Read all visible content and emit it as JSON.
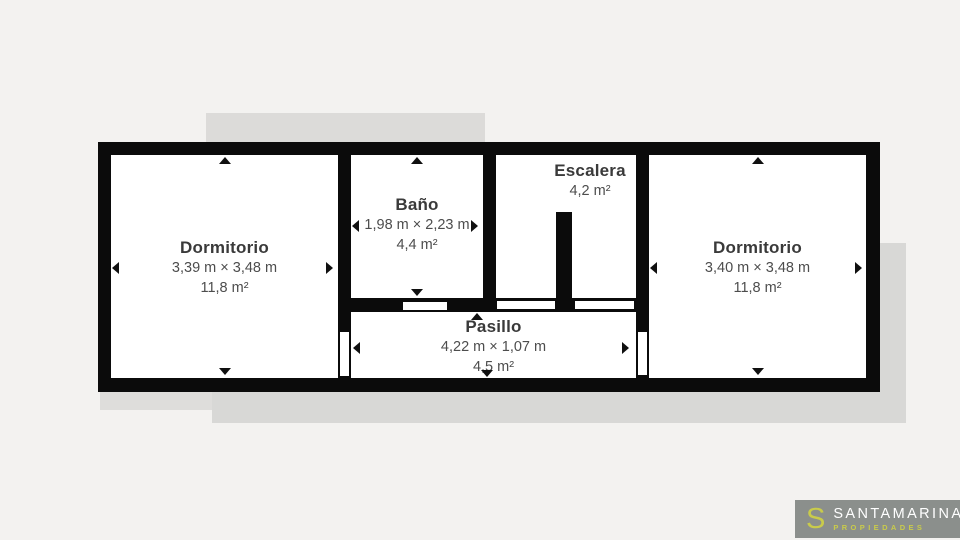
{
  "rooms": [
    {
      "id": "dormitorio-left",
      "name": "Dormitorio",
      "dimensions": "3,39 m × 3,48 m",
      "area": "11,8 m²"
    },
    {
      "id": "bano",
      "name": "Baño",
      "dimensions": "1,98 m × 2,23 m",
      "area": "4,4 m²"
    },
    {
      "id": "escalera",
      "name": "Escalera",
      "dimensions": "",
      "area": "4,2 m²"
    },
    {
      "id": "dormitorio-right",
      "name": "Dormitorio",
      "dimensions": "3,40 m × 3,48 m",
      "area": "11,8 m²"
    },
    {
      "id": "pasillo",
      "name": "Pasillo",
      "dimensions": "4,22 m × 1,07 m",
      "area": "4,5 m²"
    }
  ],
  "branding": {
    "logo_letter": "S",
    "name": "SANTAMARINA",
    "tagline": "PROPIEDADES",
    "accent_color": "#c9cb4b",
    "badge_background": "#8b8f8c"
  },
  "colors": {
    "wall": "#0b0b0b",
    "floor": "#ffffff",
    "page_background": "#f3f2f0",
    "shadow": "#d8d8d6",
    "label_text": "#3a3a3a"
  }
}
